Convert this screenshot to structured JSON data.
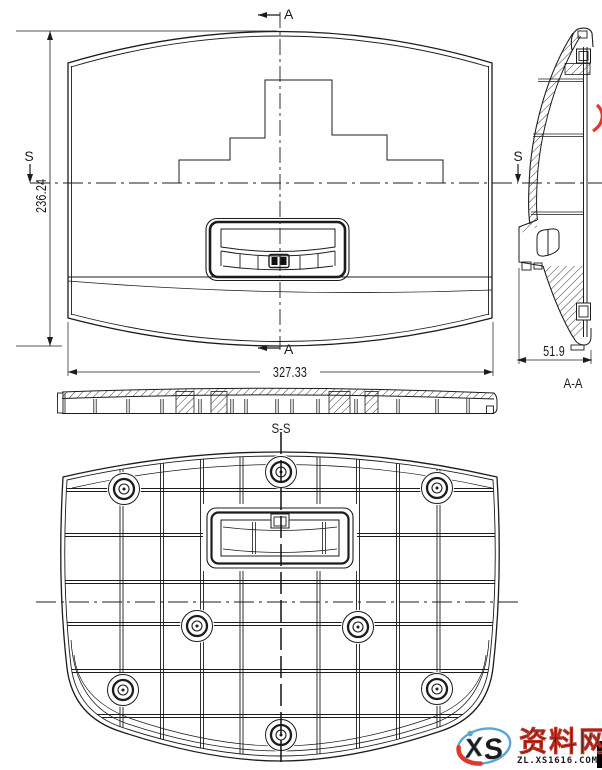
{
  "section_labels": {
    "a_top": "A",
    "a_bottom": "A",
    "s_left": "S",
    "s_right": "S",
    "aa_view": "A-A",
    "ss_view": "S-S"
  },
  "dimensions": {
    "front_height": "236.24",
    "front_width": "327.33",
    "side_depth": "51.9"
  },
  "watermark": {
    "logo_x": "X",
    "logo_s": "S",
    "site_name": "资料网",
    "site_url": "ZL.XS1616.COM"
  },
  "colors": {
    "line": "#1c1c1c",
    "watermark_red": "#e0392b",
    "watermark_blue": "#5aa7d6",
    "logo_x_fill": "#a8b4c2"
  }
}
